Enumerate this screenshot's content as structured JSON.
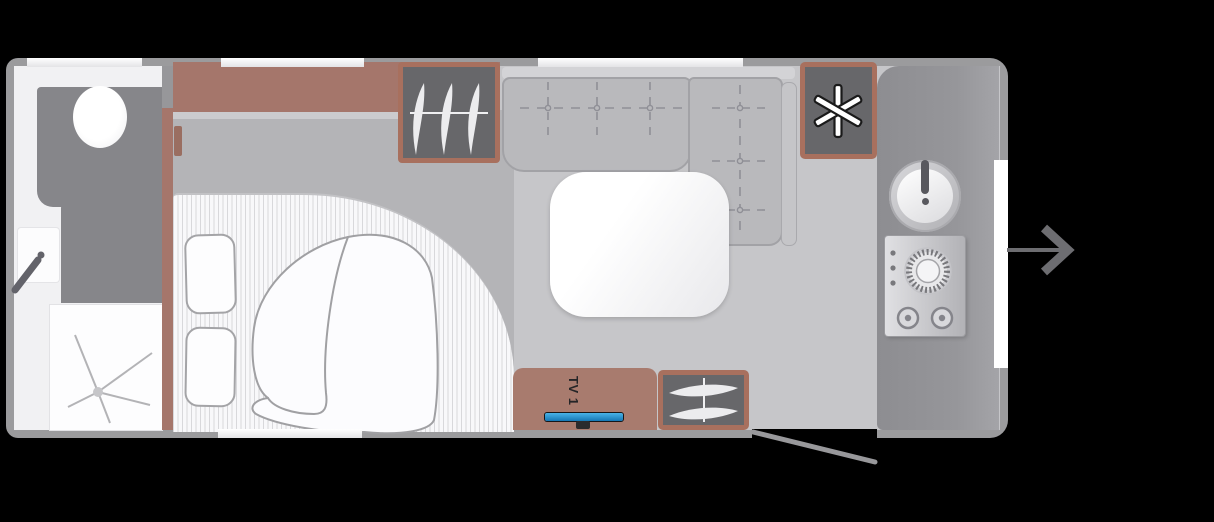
{
  "scene": {
    "kind": "caravan-floorplan-top-view",
    "labels": {
      "tv": "TV 1"
    }
  },
  "colors": {
    "background": "#000000",
    "wall_gray": "#9b9b9d",
    "floor_gray": "#c6c6c9",
    "bed_zone_gray": "#b4b4b7",
    "cabinet_brown": "#a5766b",
    "wardrobe_border_brown": "#a8705e",
    "wardrobe_fill_gray": "#67676a",
    "worktop_gray": "#8d8d91",
    "bench_gray": "#b9b9bc",
    "bathroom_white": "#f1f1f3",
    "tv_screen_blue": "#2a93cf"
  },
  "icons": [
    "toilet-icon",
    "washbasin-icon",
    "tap-lever-icon",
    "shower-drain-icon",
    "pillow-icon",
    "duvet-icon",
    "seat-tufting-icon",
    "table-icon",
    "hanger-icon",
    "snowflake-fridge-icon",
    "sink-basin-icon",
    "hob-burners-icon",
    "tv-icon",
    "open-door-icon",
    "entry-arrow-icon"
  ]
}
